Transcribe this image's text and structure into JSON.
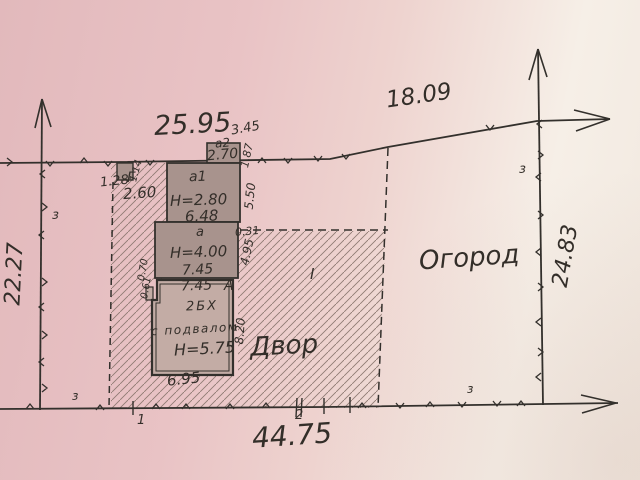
{
  "colors": {
    "paper_pink": "#e7c0c2",
    "paper_light": "#f6f0e8",
    "ink": "#332e29",
    "building_fill": "#a8938d",
    "house_fill": "#c3aca5",
    "hatch": "#8f7b73"
  },
  "boundary": {
    "dim_top_left": "25.95",
    "dim_top_right": "18.09",
    "dim_left": "22.27",
    "dim_right": "24.83",
    "dim_bottom": "44.75"
  },
  "areas": {
    "garden": "Огород",
    "yard": "Двор",
    "zone": "I"
  },
  "markers": {
    "z": "з",
    "point_1": "1",
    "point_2": "2"
  },
  "shed_g": {
    "letter": "Г",
    "dim_height": "1.14",
    "dim_width": "1.28",
    "dim_side": "2.60"
  },
  "annex_a2": {
    "label": "а2",
    "dim_top": "3.45",
    "dim_inner": "2.70",
    "dim_right": "1.87"
  },
  "annex_a1": {
    "label": "а1",
    "height": "Н=2.80",
    "dim_width": "6.48",
    "dim_right": "5.50"
  },
  "annex_a": {
    "label": "а",
    "height": "Н=4.00",
    "dim_width": "7.45",
    "dim_right": "4.95",
    "dim_offset": "0.31"
  },
  "house_a": {
    "dim_top": "7.45",
    "letter": "А",
    "type": "2БХ",
    "basement": "с подвалом",
    "height": "Н=5.75",
    "dim_bottom": "6.95",
    "dim_right": "8.20",
    "dim_notch_top": "0.70",
    "dim_notch_bottom": "0.61"
  }
}
